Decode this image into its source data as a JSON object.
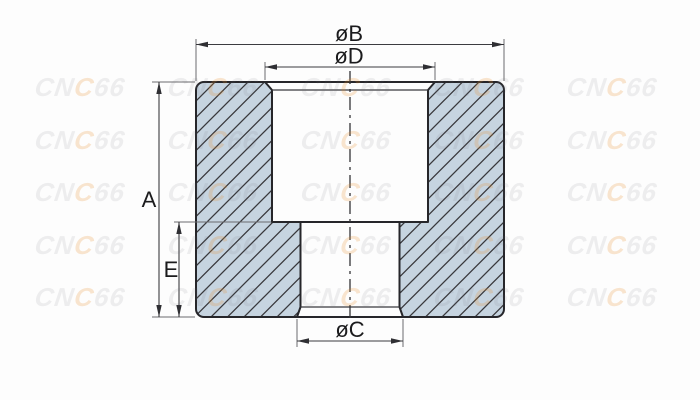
{
  "drawing": {
    "type": "cross-section technical drawing of a counterbored bushing",
    "dimensions": {
      "outer_diameter_label": "øB",
      "counterbore_diameter_label": "øD",
      "overall_height_label": "A",
      "lower_bore_height_label": "E",
      "small_bore_diameter_label": "øC"
    },
    "colors": {
      "section_fill": "#c6d4e0",
      "hatch_line": "#38383c",
      "outline": "#26262a",
      "dimension_line": "#3c3c40",
      "extension_line": "#6a6a6e",
      "label_text": "#1b1b1d",
      "background": "#fdfdfd"
    }
  },
  "watermark": {
    "text": "CNC66",
    "text_prefix": "CN",
    "text_accent": "C",
    "text_suffix": "66",
    "gray_color": "rgba(110,110,118,0.11)",
    "accent_color": "rgba(232,140,40,0.22)",
    "grid": {
      "cols": 5,
      "rows": 5,
      "x0": 35,
      "y0": 77,
      "dx": 133,
      "dy": 52.5
    }
  }
}
